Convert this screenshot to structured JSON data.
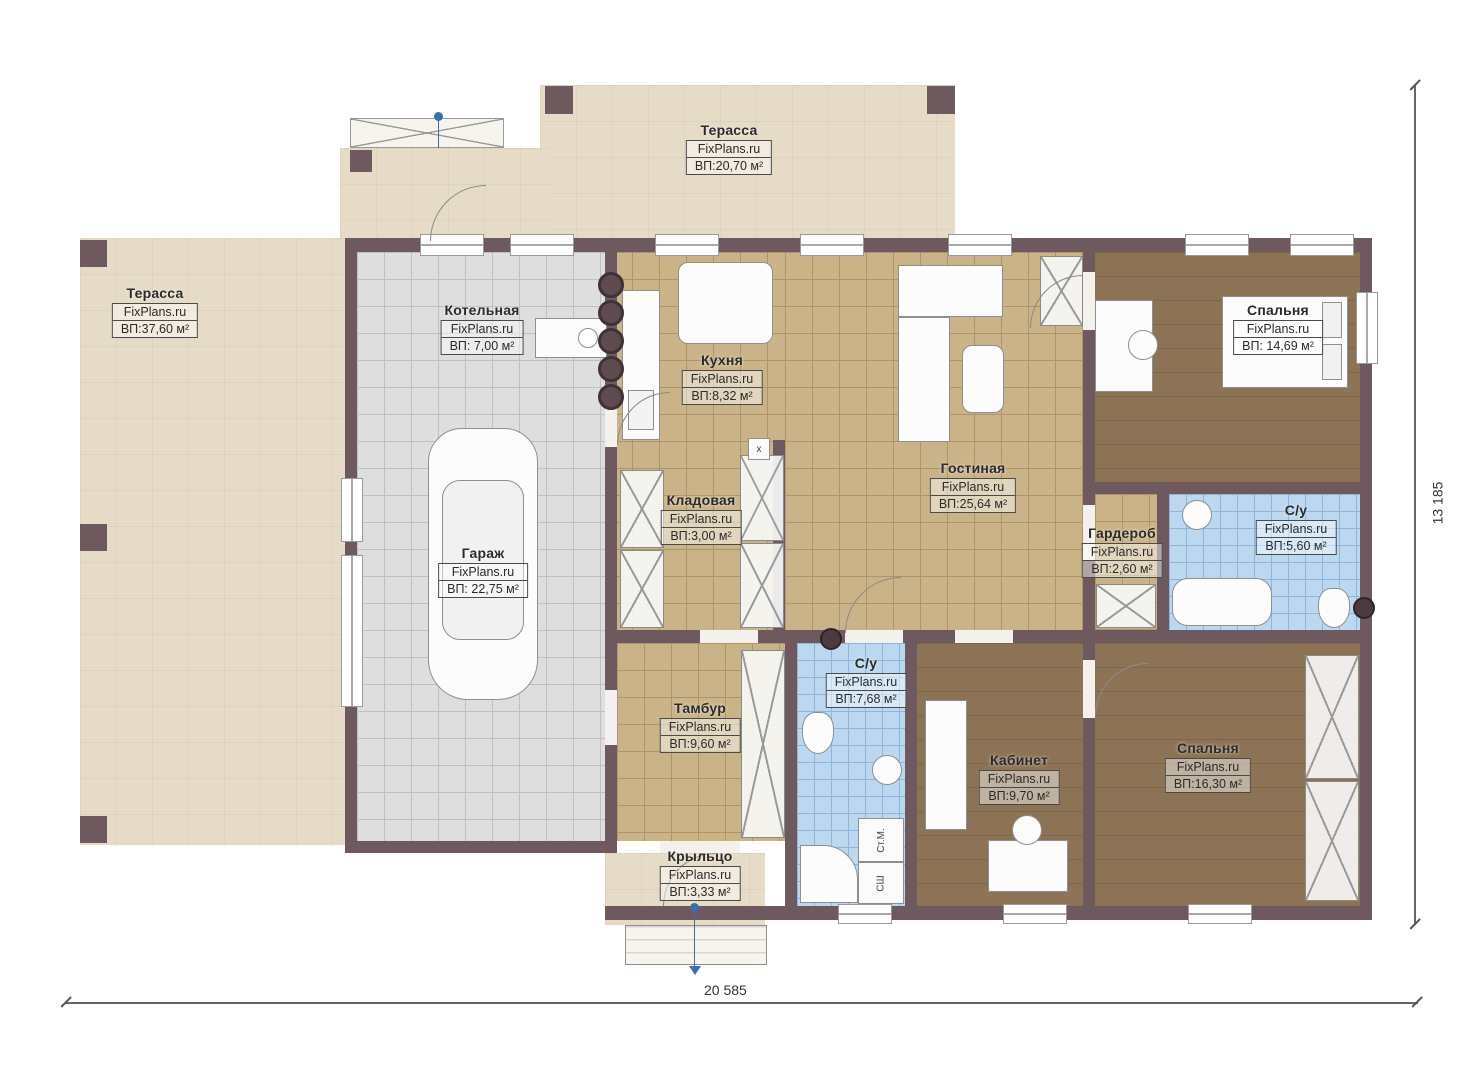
{
  "plan": {
    "title": "floor-plan",
    "watermark": "FixPlans.ru",
    "dimensions": {
      "width": "20 585",
      "height": "13 185"
    },
    "appliances": {
      "washing_machine": "Ст.М.",
      "dryer": "СШ",
      "marker": "x"
    },
    "colors": {
      "wall": "#6e595e",
      "terrace": "#e6dbc7",
      "tile_gray": "#dedede",
      "tile_tan": "#cbb389",
      "wood": "#8d7355",
      "tile_blue": "#bcd8f0"
    },
    "rooms": [
      {
        "id": "terrace-top",
        "name": "Терасса",
        "watermark": "FixPlans.ru",
        "area": "ВП:20,70 м²"
      },
      {
        "id": "terrace-left",
        "name": "Терасса",
        "watermark": "FixPlans.ru",
        "area": "ВП:37,60 м²"
      },
      {
        "id": "boiler",
        "name": "Котельная",
        "watermark": "FixPlans.ru",
        "area": "ВП: 7,00 м²"
      },
      {
        "id": "kitchen",
        "name": "Кухня",
        "watermark": "FixPlans.ru",
        "area": "ВП:8,32 м²"
      },
      {
        "id": "living",
        "name": "Гостиная",
        "watermark": "FixPlans.ru",
        "area": "ВП:25,64 м²"
      },
      {
        "id": "bedroom-1",
        "name": "Спальня",
        "watermark": "FixPlans.ru",
        "area": "ВП: 14,69 м²"
      },
      {
        "id": "storage",
        "name": "Кладовая",
        "watermark": "FixPlans.ru",
        "area": "ВП:3,00 м²"
      },
      {
        "id": "garage",
        "name": "Гараж",
        "watermark": "FixPlans.ru",
        "area": "ВП: 22,75 м²"
      },
      {
        "id": "wardrobe",
        "name": "Гардероб",
        "watermark": "FixPlans.ru",
        "area": "ВП:2,60 м²"
      },
      {
        "id": "bathroom-1",
        "name": "С/у",
        "watermark": "FixPlans.ru",
        "area": "ВП:5,60 м²"
      },
      {
        "id": "tambour",
        "name": "Тамбур",
        "watermark": "FixPlans.ru",
        "area": "ВП:9,60 м²"
      },
      {
        "id": "bathroom-2",
        "name": "С/у",
        "watermark": "FixPlans.ru",
        "area": "ВП:7,68 м²"
      },
      {
        "id": "office",
        "name": "Кабинет",
        "watermark": "FixPlans.ru",
        "area": "ВП:9,70 м²"
      },
      {
        "id": "bedroom-2",
        "name": "Спальня",
        "watermark": "FixPlans.ru",
        "area": "ВП:16,30 м²"
      },
      {
        "id": "porch",
        "name": "Крыльцо",
        "watermark": "FixPlans.ru",
        "area": "ВП:3,33 м²"
      }
    ]
  }
}
